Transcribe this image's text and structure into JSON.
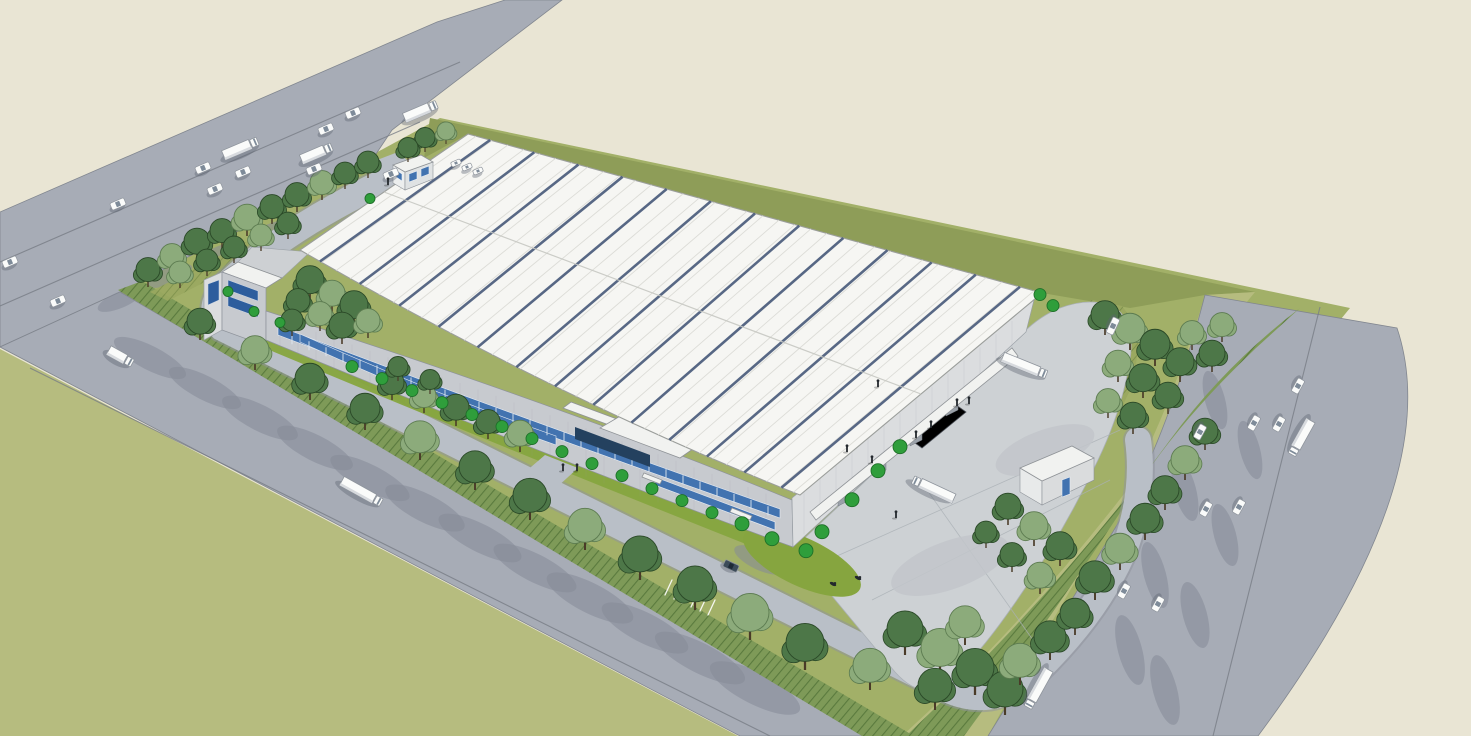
{
  "scene": {
    "subject": "warehouse-campus-aerial-rendering",
    "view": "aerial-perspective",
    "style": "sketchup-architectural-visualization"
  },
  "palette": {
    "beige": "#e9e5d4",
    "road": "#a7acb6",
    "roadEdge": "#81868f",
    "roadLine": "#787d86",
    "roadShadow": "#858b98",
    "oliveLawn": "#b6bc7f",
    "oliveStrip": "#8e9d58",
    "siteGreen": "#a2b068",
    "hedgeFill": "#7e9a58",
    "hedgeLine": "#5a7a3e",
    "paverFill": "#9aa860",
    "paverLine": "#7b8f4a",
    "bedGreen": "#86a53f",
    "internalRoad": "#b9bfc7",
    "internalEdge": "#8f949d",
    "court": "#cdd1d4",
    "courtStain": "#c2c6ca",
    "courtLine": "#aab0b5",
    "roofWhite": "#f6f6f3",
    "roofSeam": "#dcdcd7",
    "roofStripe": "#47597a",
    "ridgeLine": "#c7c8c2",
    "fascia": "#9b9e9b",
    "wallFront": "#c7cacf",
    "wallEnd": "#dbdddf",
    "wallGable": "#cdd0d3",
    "windowBlue": "#4273b0",
    "curtainBlue": "#2d5d9d",
    "canopy": "#f1f2f0",
    "glassDark": "#24415f",
    "dockDoor": "#9aa1a9",
    "treeDark": "#4d7748",
    "treeDarkLine": "#2a4827",
    "treeLight": "#8cab7b",
    "treeLightLine": "#5c7b50",
    "ball": "#2f9e3b",
    "ballLine": "#1e6f28",
    "trunk": "#4a3b28",
    "vehWhite": "#fafbfa",
    "vehLine": "#8f959d",
    "vehGlass": "#7e8b99",
    "suv": "#3c4b59",
    "person": "#23282d"
  },
  "objects": {
    "trees": [
      [
        148,
        287,
        12,
        "d"
      ],
      [
        172,
        273,
        12,
        "l"
      ],
      [
        197,
        260,
        13,
        "d"
      ],
      [
        222,
        248,
        12,
        "d"
      ],
      [
        247,
        236,
        13,
        "l"
      ],
      [
        272,
        224,
        12,
        "d"
      ],
      [
        297,
        212,
        12,
        "d"
      ],
      [
        322,
        200,
        12,
        "l"
      ],
      [
        345,
        189,
        11,
        "d"
      ],
      [
        368,
        178,
        11,
        "d"
      ],
      [
        180,
        288,
        11,
        "l"
      ],
      [
        207,
        276,
        11,
        "d"
      ],
      [
        234,
        263,
        11,
        "d"
      ],
      [
        261,
        251,
        11,
        "l"
      ],
      [
        288,
        239,
        11,
        "d"
      ],
      [
        425,
        152,
        10,
        "d"
      ],
      [
        446,
        144,
        9,
        "l"
      ],
      [
        408,
        162,
        10,
        "d"
      ],
      [
        310,
        300,
        14,
        "d"
      ],
      [
        332,
        312,
        13,
        "l"
      ],
      [
        354,
        325,
        14,
        "d"
      ],
      [
        298,
        318,
        12,
        "d"
      ],
      [
        320,
        331,
        12,
        "l"
      ],
      [
        342,
        344,
        13,
        "d"
      ],
      [
        292,
        336,
        11,
        "d"
      ],
      [
        368,
        338,
        12,
        "l"
      ],
      [
        392,
        400,
        12,
        "d"
      ],
      [
        424,
        413,
        12,
        "l"
      ],
      [
        456,
        426,
        13,
        "d"
      ],
      [
        488,
        439,
        12,
        "d"
      ],
      [
        520,
        452,
        13,
        "l"
      ],
      [
        398,
        381,
        10,
        "d"
      ],
      [
        430,
        394,
        10,
        "d"
      ],
      [
        200,
        340,
        13,
        "d"
      ],
      [
        255,
        370,
        14,
        "l"
      ],
      [
        310,
        400,
        15,
        "d"
      ],
      [
        365,
        430,
        15,
        "d"
      ],
      [
        420,
        460,
        16,
        "l"
      ],
      [
        475,
        490,
        16,
        "d"
      ],
      [
        530,
        520,
        17,
        "d"
      ],
      [
        585,
        550,
        17,
        "l"
      ],
      [
        640,
        580,
        18,
        "d"
      ],
      [
        695,
        610,
        18,
        "d"
      ],
      [
        750,
        640,
        19,
        "l"
      ],
      [
        805,
        670,
        19,
        "d"
      ],
      [
        905,
        655,
        18,
        "d"
      ],
      [
        940,
        675,
        19,
        "l"
      ],
      [
        975,
        695,
        19,
        "d"
      ],
      [
        1005,
        715,
        18,
        "d"
      ],
      [
        870,
        690,
        17,
        "l"
      ],
      [
        935,
        710,
        17,
        "d"
      ],
      [
        1020,
        685,
        17,
        "l"
      ],
      [
        1050,
        660,
        16,
        "d"
      ],
      [
        1075,
        635,
        15,
        "d"
      ],
      [
        965,
        645,
        16,
        "l"
      ],
      [
        1095,
        600,
        16,
        "d"
      ],
      [
        1120,
        570,
        15,
        "l"
      ],
      [
        1145,
        540,
        15,
        "d"
      ],
      [
        1165,
        510,
        14,
        "d"
      ],
      [
        1185,
        480,
        14,
        "l"
      ],
      [
        1205,
        450,
        13,
        "d"
      ],
      [
        1105,
        335,
        14,
        "d"
      ],
      [
        1130,
        350,
        15,
        "l"
      ],
      [
        1155,
        366,
        15,
        "d"
      ],
      [
        1180,
        382,
        14,
        "d"
      ],
      [
        1118,
        382,
        13,
        "l"
      ],
      [
        1143,
        398,
        14,
        "d"
      ],
      [
        1168,
        414,
        13,
        "d"
      ],
      [
        1108,
        418,
        12,
        "l"
      ],
      [
        1133,
        434,
        13,
        "d"
      ],
      [
        1192,
        350,
        12,
        "l"
      ],
      [
        1212,
        372,
        13,
        "d"
      ],
      [
        1222,
        342,
        12,
        "l"
      ],
      [
        1008,
        525,
        13,
        "d"
      ],
      [
        1034,
        546,
        14,
        "l"
      ],
      [
        1060,
        566,
        14,
        "d"
      ],
      [
        1012,
        572,
        12,
        "d"
      ],
      [
        1040,
        594,
        13,
        "l"
      ],
      [
        986,
        548,
        11,
        "d"
      ]
    ],
    "bushes": [
      [
        352,
        372,
        6
      ],
      [
        382,
        384,
        6
      ],
      [
        412,
        396,
        6
      ],
      [
        442,
        408,
        6
      ],
      [
        472,
        420,
        6
      ],
      [
        502,
        432,
        6
      ],
      [
        532,
        444,
        6
      ],
      [
        562,
        457,
        6
      ],
      [
        592,
        469,
        6
      ],
      [
        622,
        481,
        6
      ],
      [
        652,
        494,
        6
      ],
      [
        682,
        506,
        6
      ],
      [
        712,
        518,
        6
      ],
      [
        742,
        530,
        7
      ],
      [
        772,
        545,
        7
      ],
      [
        806,
        557,
        7
      ],
      [
        822,
        538,
        7
      ],
      [
        852,
        506,
        7
      ],
      [
        878,
        477,
        7
      ],
      [
        900,
        453,
        7
      ],
      [
        1040,
        300,
        6
      ],
      [
        1053,
        311,
        6
      ],
      [
        228,
        296,
        5
      ],
      [
        254,
        316,
        5
      ],
      [
        280,
        327,
        5
      ],
      [
        370,
        203,
        5
      ]
    ],
    "people": [
      [
        388,
        185
      ],
      [
        563,
        471
      ],
      [
        577,
        471
      ],
      [
        847,
        452
      ],
      [
        872,
        463
      ],
      [
        896,
        518
      ],
      [
        916,
        438
      ],
      [
        931,
        428
      ],
      [
        957,
        406
      ],
      [
        969,
        404
      ],
      [
        878,
        387
      ]
    ],
    "vehicles": [
      {
        "k": "car",
        "x": 10,
        "y": 262,
        "r": -23
      },
      {
        "k": "car",
        "x": 58,
        "y": 301,
        "r": -23
      },
      {
        "k": "car",
        "x": 118,
        "y": 204,
        "r": -23
      },
      {
        "k": "car",
        "x": 203,
        "y": 168,
        "r": -23
      },
      {
        "k": "car",
        "x": 243,
        "y": 172,
        "r": -23
      },
      {
        "k": "car",
        "x": 215,
        "y": 189,
        "r": -23
      },
      {
        "k": "car",
        "x": 314,
        "y": 169,
        "r": -23
      },
      {
        "k": "car",
        "x": 326,
        "y": 129,
        "r": -23
      },
      {
        "k": "car",
        "x": 353,
        "y": 113,
        "r": -23
      },
      {
        "k": "truck",
        "x": 241,
        "y": 148,
        "r": -23,
        "l": 38
      },
      {
        "k": "truck",
        "x": 317,
        "y": 153,
        "r": -23,
        "l": 34
      },
      {
        "k": "truck",
        "x": 421,
        "y": 111,
        "r": -23,
        "l": 36
      },
      {
        "k": "car",
        "x": 391,
        "y": 174,
        "r": -23
      },
      {
        "k": "mini",
        "x": 456,
        "y": 163,
        "r": -23
      },
      {
        "k": "mini",
        "x": 467,
        "y": 167,
        "r": -23
      },
      {
        "k": "mini",
        "x": 478,
        "y": 171,
        "r": -23
      },
      {
        "k": "truck",
        "x": 121,
        "y": 357,
        "r": 29,
        "l": 28
      },
      {
        "k": "truck",
        "x": 362,
        "y": 492,
        "r": 29,
        "l": 46
      },
      {
        "k": "car",
        "x": 1298,
        "y": 386,
        "r": 119
      },
      {
        "k": "car",
        "x": 1254,
        "y": 423,
        "r": 119
      },
      {
        "k": "car",
        "x": 1279,
        "y": 424,
        "r": 119
      },
      {
        "k": "car",
        "x": 1206,
        "y": 509,
        "r": 119
      },
      {
        "k": "car",
        "x": 1239,
        "y": 507,
        "r": 119
      },
      {
        "k": "car",
        "x": 1124,
        "y": 591,
        "r": 119
      },
      {
        "k": "car",
        "x": 1158,
        "y": 604,
        "r": 119
      },
      {
        "k": "car",
        "x": 1200,
        "y": 432,
        "r": 119
      },
      {
        "k": "truck",
        "x": 1301,
        "y": 438,
        "r": 119,
        "l": 40
      },
      {
        "k": "truck",
        "x": 1038,
        "y": 689,
        "r": 119,
        "l": 44
      },
      {
        "k": "van",
        "x": 1113,
        "y": 326,
        "r": 115
      },
      {
        "k": "truck",
        "x": 1025,
        "y": 366,
        "r": 22,
        "l": 48
      },
      {
        "k": "truck",
        "x": 933,
        "y": 489,
        "r": 25,
        "l": 46,
        "cab": -1
      },
      {
        "k": "suv",
        "x": 731,
        "y": 566,
        "r": 25
      },
      {
        "k": "bike",
        "x": 833,
        "y": 584,
        "r": 25
      },
      {
        "k": "bike",
        "x": 858,
        "y": 578,
        "r": 25
      }
    ],
    "shadows": [
      [
        150,
        358,
        40,
        12,
        27
      ],
      [
        205,
        388,
        40,
        12,
        27
      ],
      [
        260,
        418,
        42,
        13,
        27
      ],
      [
        315,
        448,
        42,
        13,
        27
      ],
      [
        370,
        478,
        44,
        13,
        27
      ],
      [
        425,
        508,
        44,
        14,
        27
      ],
      [
        480,
        538,
        46,
        14,
        27
      ],
      [
        535,
        568,
        46,
        14,
        27
      ],
      [
        590,
        598,
        48,
        15,
        27
      ],
      [
        645,
        628,
        48,
        15,
        27
      ],
      [
        700,
        658,
        50,
        15,
        27
      ],
      [
        755,
        688,
        50,
        16,
        27
      ],
      [
        1215,
        400,
        30,
        10,
        75
      ],
      [
        1250,
        450,
        30,
        10,
        75
      ],
      [
        1185,
        490,
        32,
        11,
        75
      ],
      [
        1225,
        535,
        32,
        11,
        75
      ],
      [
        1155,
        575,
        34,
        11,
        75
      ],
      [
        1195,
        615,
        34,
        12,
        75
      ],
      [
        1130,
        650,
        36,
        12,
        75
      ],
      [
        1165,
        690,
        36,
        12,
        75
      ],
      [
        120,
        300,
        24,
        8,
        -23
      ],
      [
        170,
        276,
        24,
        8,
        -23
      ],
      [
        220,
        254,
        24,
        8,
        -23
      ],
      [
        270,
        232,
        24,
        8,
        -23
      ],
      [
        320,
        210,
        24,
        8,
        -23
      ],
      [
        850,
        590,
        40,
        13,
        25
      ],
      [
        940,
        545,
        34,
        12,
        25
      ],
      [
        1040,
        480,
        30,
        11,
        25
      ],
      [
        760,
        560,
        28,
        10,
        25
      ]
    ]
  }
}
